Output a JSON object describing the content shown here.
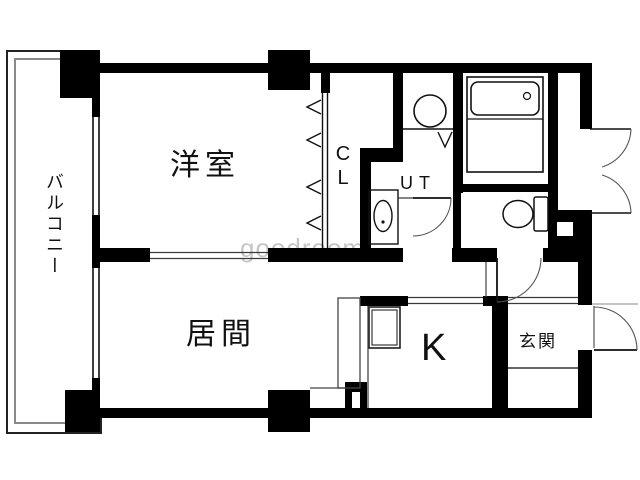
{
  "floorplan": {
    "rooms": {
      "western_room": "洋室",
      "living_room": "居間",
      "kitchen": "K",
      "entrance": "玄関",
      "closet": "CL",
      "utility": "UT",
      "balcony": "バルコニー"
    },
    "watermark": "goodroom",
    "fixtures": {
      "bathtub": "bathtub",
      "toilet": "toilet",
      "washbasin": "washbasin",
      "washing_machine": "washing-machine"
    },
    "colors": {
      "wall": "#000000",
      "thin_line": "#333333",
      "gray_line": "#888888",
      "watermark": "#c6c6c6",
      "background": "#ffffff"
    }
  }
}
